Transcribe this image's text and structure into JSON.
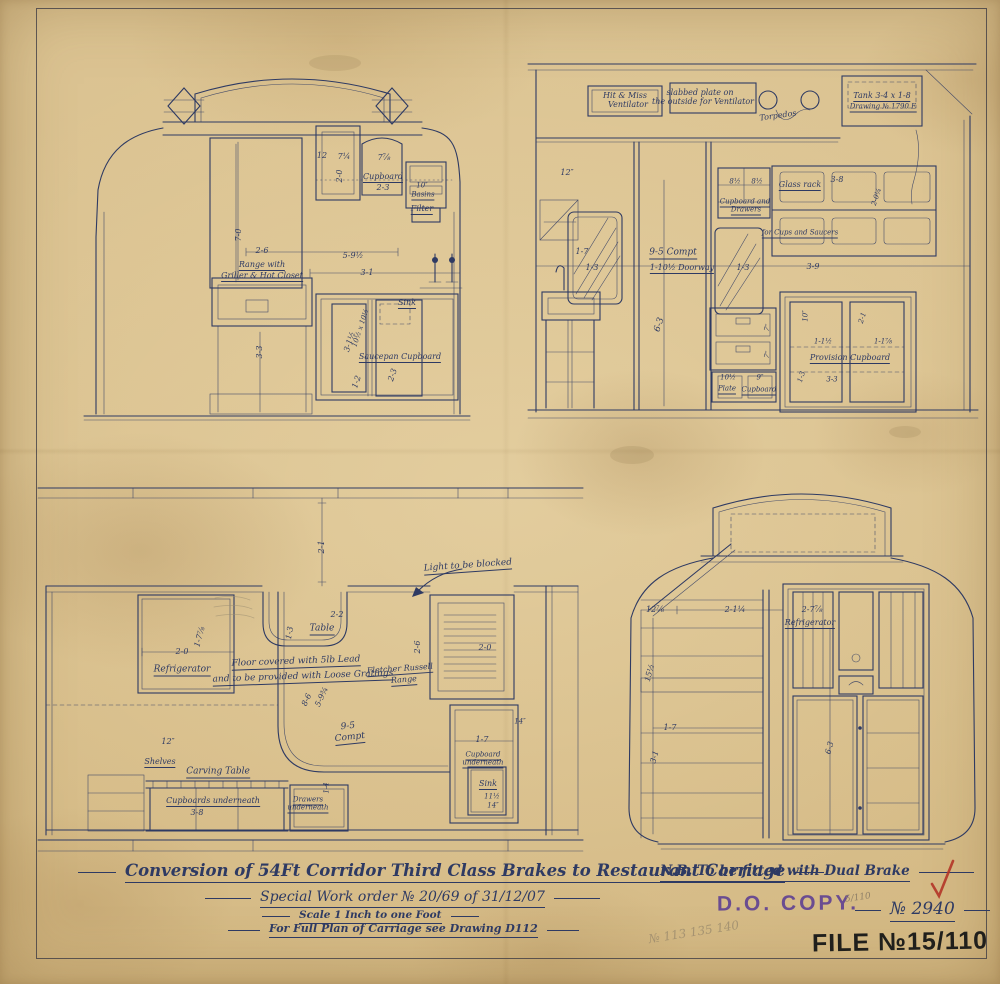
{
  "colors": {
    "ink": "#2e3a63",
    "paper": "#d9bf8d",
    "stamp_purple": "#5c3d93",
    "stamp_black": "#201f1c",
    "check_red": "#b23527",
    "pencil": "#8f8068"
  },
  "title_block": {
    "title": "Conversion of 54Ft Corridor Third Class Brakes to Restaurant Carriage",
    "nb_note": "N.B. To be fitted with Dual Brake",
    "work_order": "Special Work order № 20/69 of 31/12/07",
    "scale_note": "Scale 1 Inch to one Foot",
    "plan_ref": "For Full Plan of Carriage see Drawing D112",
    "do_copy_stamp": "D.O. COPY.",
    "drawing_number": "№ 2940",
    "file_stamp": "FILE №15/110",
    "pencil_fraction": "5/110",
    "pencil_numbers": "№ 113  135  140"
  },
  "drawings": {
    "end_elevation": [
      {
        "t": "12",
        "x": 322,
        "y": 156,
        "s": 8
      },
      {
        "t": "7¼",
        "x": 344,
        "y": 157,
        "s": 8
      },
      {
        "t": "7⅞",
        "x": 384,
        "y": 158,
        "s": 8
      },
      {
        "t": "2-0",
        "x": 340,
        "y": 176,
        "s": 8,
        "r": -90
      },
      {
        "t": "Cupboard",
        "x": 383,
        "y": 178,
        "s": 8,
        "u": 1,
        "n": "cupboard-label"
      },
      {
        "t": "2-3",
        "x": 383,
        "y": 188,
        "s": 8
      },
      {
        "t": "10″",
        "x": 422,
        "y": 186,
        "s": 7
      },
      {
        "t": "Basins",
        "x": 423,
        "y": 196,
        "s": 7,
        "u": 1,
        "n": "basins-label"
      },
      {
        "t": "Filter",
        "x": 422,
        "y": 210,
        "s": 8,
        "u": 1,
        "n": "filter-label"
      },
      {
        "t": "7-0",
        "x": 239,
        "y": 235,
        "s": 8,
        "r": -90
      },
      {
        "t": "2-6",
        "x": 262,
        "y": 251,
        "s": 8
      },
      {
        "t": "5-9½",
        "x": 353,
        "y": 256,
        "s": 8
      },
      {
        "t": "3-1",
        "x": 367,
        "y": 273,
        "s": 8
      },
      {
        "t": "Range with",
        "x": 262,
        "y": 266,
        "s": 8,
        "u": 1,
        "n": "range-label"
      },
      {
        "t": "Griller & Hot Closet",
        "x": 262,
        "y": 277,
        "s": 8,
        "u": 1
      },
      {
        "t": "3-3",
        "x": 260,
        "y": 352,
        "s": 8,
        "r": -90
      },
      {
        "t": "Sink",
        "x": 407,
        "y": 304,
        "s": 8,
        "u": 1,
        "n": "sink-label"
      },
      {
        "t": "3-1½",
        "x": 350,
        "y": 342,
        "s": 8,
        "r": -72
      },
      {
        "t": "10½ x 10½",
        "x": 361,
        "y": 328,
        "s": 7,
        "r": -72
      },
      {
        "t": "Saucepan Cupboard",
        "x": 400,
        "y": 358,
        "s": 8,
        "u": 1,
        "n": "saucepan-cupboard-label"
      },
      {
        "t": "1-2",
        "x": 357,
        "y": 382,
        "s": 8,
        "r": -72
      },
      {
        "t": "2-3",
        "x": 393,
        "y": 375,
        "s": 8,
        "r": -72
      }
    ],
    "interior_elevation": [
      {
        "t": "Hit & Miss",
        "x": 625,
        "y": 96,
        "s": 8,
        "n": "hit-miss-ventilator-label"
      },
      {
        "t": "Ventilator",
        "x": 628,
        "y": 105,
        "s": 8
      },
      {
        "t": "slabbed plate on",
        "x": 700,
        "y": 93,
        "s": 8,
        "n": "slabbed-plate-note"
      },
      {
        "t": "the outside for Ventilator",
        "x": 703,
        "y": 102,
        "s": 8
      },
      {
        "t": "Torpedos",
        "x": 778,
        "y": 116,
        "s": 8,
        "r": -8,
        "n": "torpedos-label"
      },
      {
        "t": "Tank 3-4 x 1-8",
        "x": 882,
        "y": 97,
        "s": 8,
        "u": 1,
        "n": "tank-label"
      },
      {
        "t": "Drawing № 1790 E",
        "x": 883,
        "y": 108,
        "s": 7,
        "u": 1
      },
      {
        "t": "12″",
        "x": 567,
        "y": 173,
        "s": 8
      },
      {
        "t": "1-7",
        "x": 582,
        "y": 252,
        "s": 8
      },
      {
        "t": "1-3",
        "x": 592,
        "y": 268,
        "s": 8
      },
      {
        "t": "9-5 Compt",
        "x": 673,
        "y": 254,
        "s": 9,
        "u": 1,
        "n": "compartment-label"
      },
      {
        "t": "1-10½ Doorway",
        "x": 682,
        "y": 269,
        "s": 8,
        "u": 1,
        "n": "doorway-label"
      },
      {
        "t": "6-3",
        "x": 660,
        "y": 325,
        "s": 9,
        "r": -72
      },
      {
        "t": "1-3",
        "x": 743,
        "y": 268,
        "s": 8
      },
      {
        "t": "8½",
        "x": 735,
        "y": 182,
        "s": 7
      },
      {
        "t": "8½",
        "x": 757,
        "y": 182,
        "s": 7
      },
      {
        "t": "Cupboard and",
        "x": 745,
        "y": 203,
        "s": 7,
        "u": 1,
        "n": "cupboard-drawers-label"
      },
      {
        "t": "Drawers",
        "x": 746,
        "y": 211,
        "s": 7,
        "u": 1
      },
      {
        "t": "Glass rack",
        "x": 800,
        "y": 186,
        "s": 8,
        "u": 1,
        "n": "glass-rack-label"
      },
      {
        "t": "3-8",
        "x": 837,
        "y": 180,
        "s": 8
      },
      {
        "t": "2-0¼",
        "x": 877,
        "y": 197,
        "s": 7,
        "r": -72
      },
      {
        "t": "for Cups and Saucers",
        "x": 800,
        "y": 234,
        "s": 7,
        "u": 1,
        "n": "cups-saucers-label"
      },
      {
        "t": "3-9",
        "x": 813,
        "y": 267,
        "s": 8
      },
      {
        "t": "7″",
        "x": 768,
        "y": 328,
        "s": 7,
        "r": -72
      },
      {
        "t": "7″",
        "x": 768,
        "y": 355,
        "s": 7,
        "r": -72
      },
      {
        "t": "10½",
        "x": 728,
        "y": 378,
        "s": 7
      },
      {
        "t": "Plate",
        "x": 727,
        "y": 390,
        "s": 7,
        "u": 1,
        "n": "plate-cupboard-label"
      },
      {
        "t": "9″",
        "x": 760,
        "y": 378,
        "s": 7
      },
      {
        "t": "Cupboard",
        "x": 759,
        "y": 391,
        "s": 7,
        "u": 1
      },
      {
        "t": "Provision Cupboard",
        "x": 850,
        "y": 359,
        "s": 8,
        "u": 1,
        "n": "provision-cupboard-label"
      },
      {
        "t": "10″",
        "x": 806,
        "y": 316,
        "s": 7,
        "r": -90
      },
      {
        "t": "2-1",
        "x": 863,
        "y": 318,
        "s": 7,
        "r": -72
      },
      {
        "t": "1-1½",
        "x": 823,
        "y": 342,
        "s": 7
      },
      {
        "t": "1-1⅞",
        "x": 883,
        "y": 342,
        "s": 7
      },
      {
        "t": "1-3",
        "x": 802,
        "y": 377,
        "s": 7,
        "r": -72
      },
      {
        "t": "3-3",
        "x": 832,
        "y": 380,
        "s": 7
      }
    ],
    "floor_plan": [
      {
        "t": "2-1",
        "x": 322,
        "y": 547,
        "s": 8,
        "r": -90
      },
      {
        "t": "Light to be blocked",
        "x": 468,
        "y": 567,
        "s": 9,
        "u": 1,
        "r": -4,
        "n": "light-blocked-note"
      },
      {
        "t": "2-2",
        "x": 337,
        "y": 615,
        "s": 8
      },
      {
        "t": "Table",
        "x": 322,
        "y": 630,
        "s": 9,
        "u": 1,
        "n": "table-label"
      },
      {
        "t": "1-3",
        "x": 290,
        "y": 633,
        "s": 8,
        "r": -80
      },
      {
        "t": "2-0",
        "x": 182,
        "y": 652,
        "s": 8
      },
      {
        "t": "1-7⅞",
        "x": 200,
        "y": 637,
        "s": 8,
        "r": -75
      },
      {
        "t": "Refrigerator",
        "x": 182,
        "y": 671,
        "s": 9,
        "u": 1,
        "n": "refrigerator-label"
      },
      {
        "t": "Floor covered with 5lb Lead",
        "x": 296,
        "y": 663,
        "s": 9,
        "u": 1,
        "r": -2,
        "n": "floor-note"
      },
      {
        "t": "and to be provided with Loose Gratings",
        "x": 303,
        "y": 678,
        "s": 9,
        "u": 1,
        "r": -2
      },
      {
        "t": "Fletcher Russell",
        "x": 400,
        "y": 670,
        "s": 8,
        "u": 1,
        "r": -4,
        "n": "range-maker-label"
      },
      {
        "t": "Range",
        "x": 404,
        "y": 681,
        "s": 8,
        "u": 1,
        "r": -4
      },
      {
        "t": "8-6",
        "x": 307,
        "y": 700,
        "s": 8,
        "r": -65
      },
      {
        "t": "5-9¾",
        "x": 322,
        "y": 697,
        "s": 8,
        "r": -65
      },
      {
        "t": "9-5",
        "x": 348,
        "y": 727,
        "s": 9,
        "r": -6
      },
      {
        "t": "Compt",
        "x": 350,
        "y": 739,
        "s": 9,
        "u": 1,
        "r": -6,
        "n": "compt-label"
      },
      {
        "t": "12″",
        "x": 168,
        "y": 742,
        "s": 8
      },
      {
        "t": "Shelves",
        "x": 160,
        "y": 763,
        "s": 8,
        "u": 1,
        "n": "shelves-label"
      },
      {
        "t": "Carving Table",
        "x": 218,
        "y": 773,
        "s": 9,
        "u": 1,
        "n": "carving-table-label"
      },
      {
        "t": "Cupboards underneath",
        "x": 213,
        "y": 802,
        "s": 8,
        "u": 1,
        "n": "cupboards-underneath-label"
      },
      {
        "t": "3-8",
        "x": 197,
        "y": 813,
        "s": 8
      },
      {
        "t": "Drawers",
        "x": 308,
        "y": 801,
        "s": 7,
        "u": 1,
        "n": "drawers-underneath-label"
      },
      {
        "t": "underneath",
        "x": 308,
        "y": 809,
        "s": 7,
        "u": 1
      },
      {
        "t": "1-4",
        "x": 327,
        "y": 788,
        "s": 7,
        "r": -90
      },
      {
        "t": "2-6",
        "x": 418,
        "y": 647,
        "s": 8,
        "r": -90
      },
      {
        "t": "2-0",
        "x": 485,
        "y": 648,
        "s": 8
      },
      {
        "t": "14″",
        "x": 520,
        "y": 722,
        "s": 7
      },
      {
        "t": "1-7",
        "x": 482,
        "y": 740,
        "s": 8
      },
      {
        "t": "Cupboard",
        "x": 483,
        "y": 756,
        "s": 7,
        "u": 1,
        "n": "cupboard-underneath-label"
      },
      {
        "t": "underneath",
        "x": 483,
        "y": 764,
        "s": 7,
        "u": 1
      },
      {
        "t": "Sink",
        "x": 488,
        "y": 785,
        "s": 8,
        "u": 1,
        "n": "plan-sink-label"
      },
      {
        "t": "11½",
        "x": 492,
        "y": 797,
        "s": 7
      },
      {
        "t": "14″",
        "x": 493,
        "y": 806,
        "s": 7
      }
    ],
    "end_elevation_b": [
      {
        "t": "12⅞",
        "x": 655,
        "y": 610,
        "s": 8
      },
      {
        "t": "2-1¼",
        "x": 735,
        "y": 610,
        "s": 8
      },
      {
        "t": "2-7⅞",
        "x": 812,
        "y": 610,
        "s": 8
      },
      {
        "t": "Refrigerator",
        "x": 810,
        "y": 624,
        "s": 8,
        "u": 1,
        "n": "refrigerator-b-label"
      },
      {
        "t": "15½",
        "x": 650,
        "y": 673,
        "s": 8,
        "r": -75
      },
      {
        "t": "1-7",
        "x": 670,
        "y": 728,
        "s": 8
      },
      {
        "t": "3-1",
        "x": 655,
        "y": 757,
        "s": 8,
        "r": -75
      },
      {
        "t": "6-3",
        "x": 830,
        "y": 748,
        "s": 8,
        "r": -75
      }
    ]
  }
}
